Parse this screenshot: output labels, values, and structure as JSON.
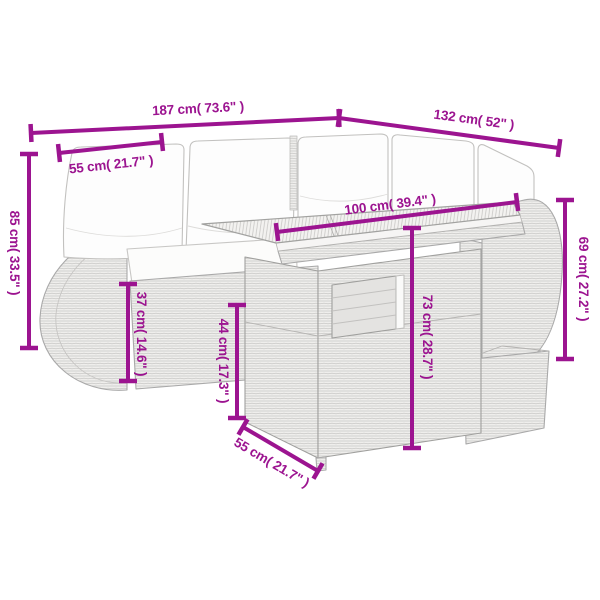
{
  "diagram": {
    "kind": "product-dimension-diagram",
    "subject": "corner-sofa-set-with-table-and-footstool"
  },
  "colors": {
    "dimension": "#9c1490",
    "background": "#ffffff",
    "line_art": "#a9a9a9",
    "cushion": "#fdfdfd"
  },
  "dimensions": [
    {
      "id": "back-width",
      "label": "187 cm( 73.6\" )",
      "cm": 187,
      "inches": 73.6
    },
    {
      "id": "side-depth",
      "label": "132 cm( 52\" )",
      "cm": 132,
      "inches": 52
    },
    {
      "id": "seat-width",
      "label": "55 cm( 21.7\" )",
      "cm": 55,
      "inches": 21.7
    },
    {
      "id": "back-height",
      "label": "85 cm( 33.5\" )",
      "cm": 85,
      "inches": 33.5
    },
    {
      "id": "table-top-length",
      "label": "100 cm( 39.4\" )",
      "cm": 100,
      "inches": 39.4
    },
    {
      "id": "table-height",
      "label": "73 cm( 28.7\" )",
      "cm": 73,
      "inches": 28.7
    },
    {
      "id": "armrest-height",
      "label": "69 cm( 27.2\" )",
      "cm": 69,
      "inches": 27.2
    },
    {
      "id": "seat-height",
      "label": "37 cm( 14.6\" )",
      "cm": 37,
      "inches": 14.6
    },
    {
      "id": "table-front-height",
      "label": "44 cm( 17.3\" )",
      "cm": 44,
      "inches": 17.3
    },
    {
      "id": "table-depth",
      "label": "55 cm( 21.7\" )",
      "cm": 55,
      "inches": 21.7
    }
  ]
}
